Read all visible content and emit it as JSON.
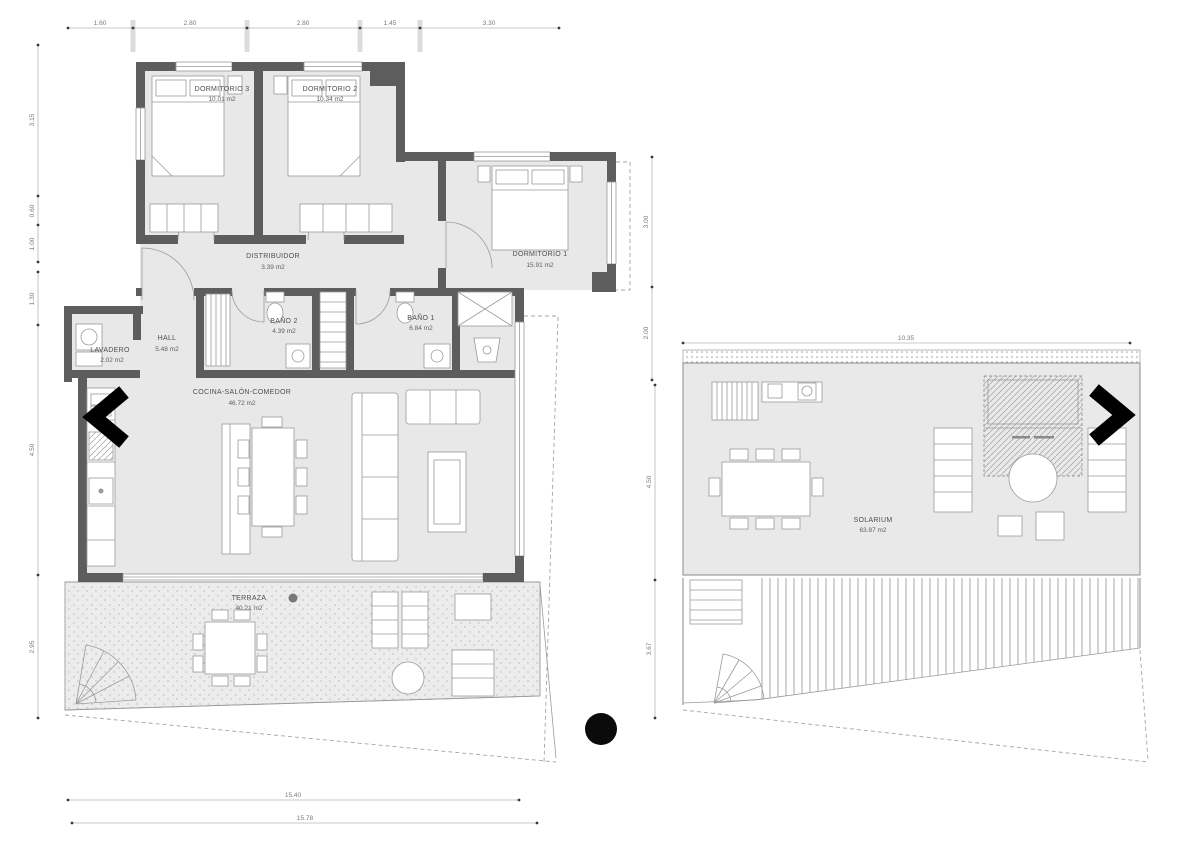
{
  "title": "apartment-floor-plan",
  "colors": {
    "wall": "#5d5d5d",
    "room_fill": "#e8e8e8",
    "arrow": "#000000",
    "dim_text": "#7a7a7a"
  },
  "apartment": {
    "rooms": [
      {
        "name": "DORMITORIO 3",
        "area": "10.01 m2"
      },
      {
        "name": "DORMITORIO 2",
        "area": "10.34 m2"
      },
      {
        "name": "DORMITORIO 1",
        "area": "15.91 m2"
      },
      {
        "name": "DISTRIBUIDOR",
        "area": "3.39 m2"
      },
      {
        "name": "HALL",
        "area": "5.48 m2"
      },
      {
        "name": "LAVADERO",
        "area": "2.02 m2"
      },
      {
        "name": "BAÑO 2",
        "area": "4.39 m2"
      },
      {
        "name": "BAÑO 1",
        "area": "6.84 m2"
      },
      {
        "name": "COCINA-SALÓN-COMEDOR",
        "area": "46.72 m2"
      },
      {
        "name": "TERRAZA",
        "area": "40.21 m2"
      }
    ],
    "dims": {
      "top": [
        "1.60",
        "2.80",
        "2.80",
        "1.45",
        "3.30"
      ],
      "left": [
        "3.15",
        "0.60",
        "1.00",
        "1.30",
        "4.50",
        "2.95"
      ],
      "right": [
        "3.00",
        "2.00"
      ],
      "bottom": [
        "15.40",
        "15.78"
      ]
    }
  },
  "solarium": {
    "rooms": [
      {
        "name": "SOLARIUM",
        "area": "63.87 m2"
      }
    ],
    "dims": {
      "top": [
        "10.35"
      ],
      "left": [
        "4.50",
        "3.67"
      ]
    }
  }
}
